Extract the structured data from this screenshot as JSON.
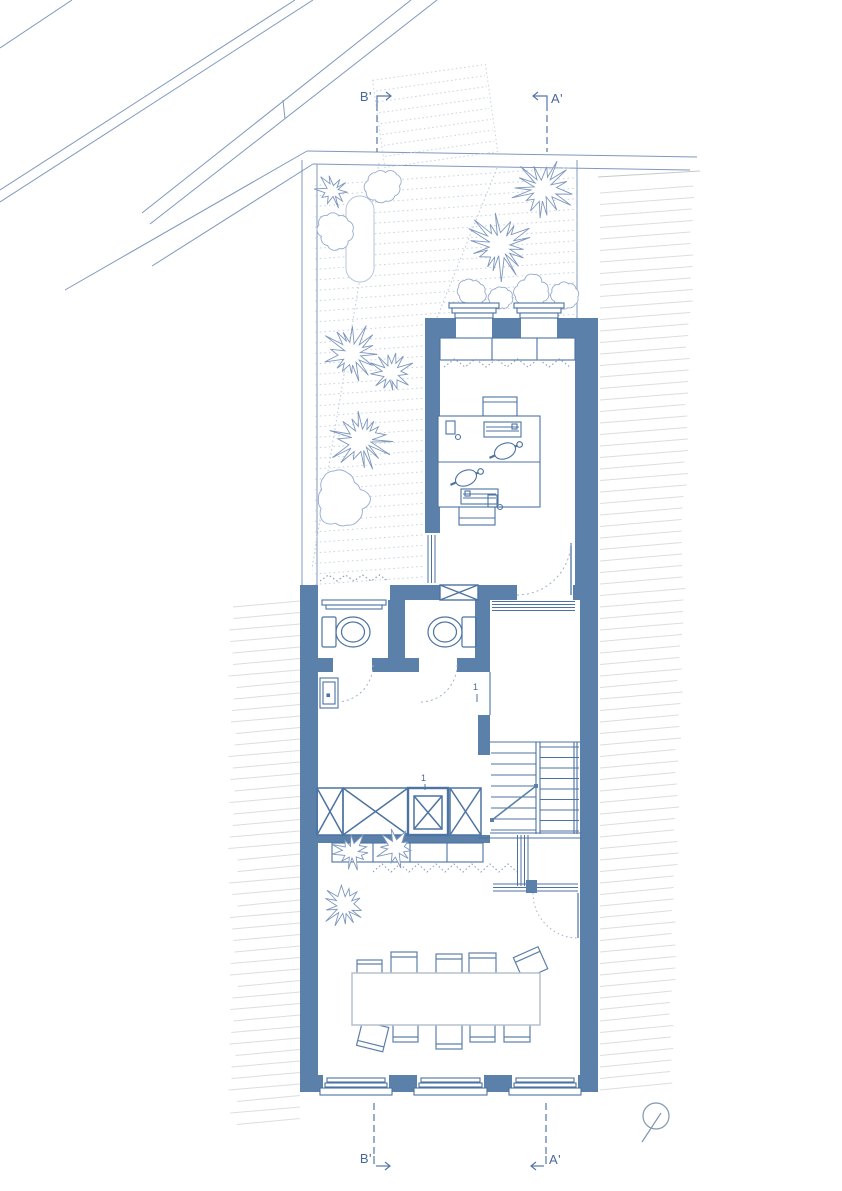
{
  "document": {
    "type": "architectural floor plan",
    "style": "blueprint line drawing, blue on white"
  },
  "labels": {
    "section_b_top": "B'",
    "section_a_top": "A'",
    "section_b_bottom": "B'",
    "section_a_bottom": "A'",
    "door_tag_hall": "1",
    "door_tag_elevator": "1"
  },
  "symbols": {
    "north_indicator": "circle-with-needle",
    "elevator": "double-square-with-cross",
    "shafts": "crossed-boxes",
    "stairs": "parallel-tread-flights",
    "section_cut_lines": "dashed-with-direction-arrows"
  },
  "colors": {
    "wall_fill": "#5b80aa",
    "line": "#4c73a1",
    "light_line": "#7f98bc",
    "tree_outline": "#96abcc",
    "shrub_outline": "#7e97bd",
    "neighbor_hatch": "#dcdde1",
    "garden_dots": "#c9d3e0",
    "table_outline": "#b6c0cd",
    "label_text": "#47699a"
  }
}
